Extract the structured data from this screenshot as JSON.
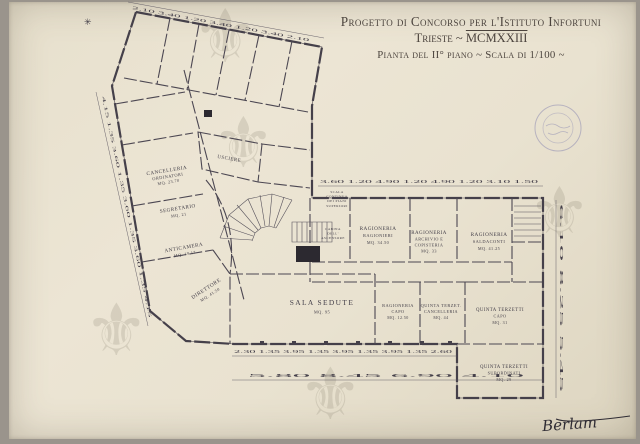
{
  "colors": {
    "paper": "#e9e2d0",
    "ink": "#45404a",
    "stamp_blue": "#6868a6",
    "backdrop": "#9a948c"
  },
  "title": {
    "line1": "Progetto di Concorso per l'Istituto Infortuni",
    "line2_city": "Trieste ~",
    "line2_year": "MCMXXIII",
    "line3": "Pianta del II° piano ~ Scala di 1/100 ~"
  },
  "plan": {
    "rooms": {
      "cancelleria": {
        "l1": "CANCELLERIA",
        "l2": "ORDINATORI",
        "l3": "MQ. 23.70"
      },
      "segretario": {
        "l1": "SEGRETARIO",
        "l3": "MQ. 21"
      },
      "anticamera": {
        "l1": "ANTICAMERA",
        "l3": "MQ. 19.17"
      },
      "direttore": {
        "l1": "DIRETTORE",
        "l3": "MQ. 41.50"
      },
      "usciere": {
        "l1": "USCIERE"
      },
      "sala_sedute": {
        "l1": "SALA SEDUTE",
        "l3": "MQ. 95"
      },
      "ragioneria_ragionieri": {
        "l1": "RAGIONERIA",
        "l2": "RAGIONIERI",
        "l3": "MQ. 34.50"
      },
      "ragioneria_archivio": {
        "l1": "RAGIONERIA",
        "l2": "ARCHIVIO E",
        "l2b": "COPISTERIA",
        "l3": "MQ. 33"
      },
      "ragioneria_saldaconti": {
        "l1": "RAGIONERIA",
        "l2": "SALDACONTI",
        "l3": "MQ. 41.25"
      },
      "ragioneria_capo": {
        "l1": "RAGIONERIA",
        "l2": "CAPO",
        "l3": "MQ. 12.50"
      },
      "quinta_cancelleria": {
        "l1": "QUINTA TERZET.",
        "l2": "CANCELLERIA",
        "l3": "MQ. 44"
      },
      "quinta_capo": {
        "l1": "QUINTA TERZETTI",
        "l2": "CAPO",
        "l3": "MQ. 31"
      },
      "quinta_subordinati": {
        "l1": "QUINTA TERZETTI",
        "l2": "SUBORDINATI",
        "l3": "MQ. 29"
      }
    },
    "notes": {
      "stair": {
        "l1": "SCALA",
        "l2": "CONTINUA",
        "l3": "DEI PIANI",
        "l4": "SUPERIORI"
      },
      "elevator": {
        "l1": "CABINA",
        "l2": "DELL'",
        "l3": "ASCENSORE"
      }
    },
    "dims": {
      "top_a": "2.10  3.40  1.20  3.40  1.20  3.40  2.10",
      "top_c": "3.60  1.20  4.90  1.20  4.90  1.20  3.10  1.50",
      "bottom_inner": "2.30  1.35  3.95  1.35  3.95  1.35  3.95  1.35  2.60",
      "bottom_outer": "5.80   8.45   6.90   4.10",
      "left": "4.15  1.35  3.60  1.35  3.60  1.35  3.60  1.35  4.15",
      "right": "6.10   8.25   5.45"
    }
  },
  "marks": {
    "asterisk": "✳",
    "watermark_glyph": "⚜"
  },
  "signature": "Berlam"
}
